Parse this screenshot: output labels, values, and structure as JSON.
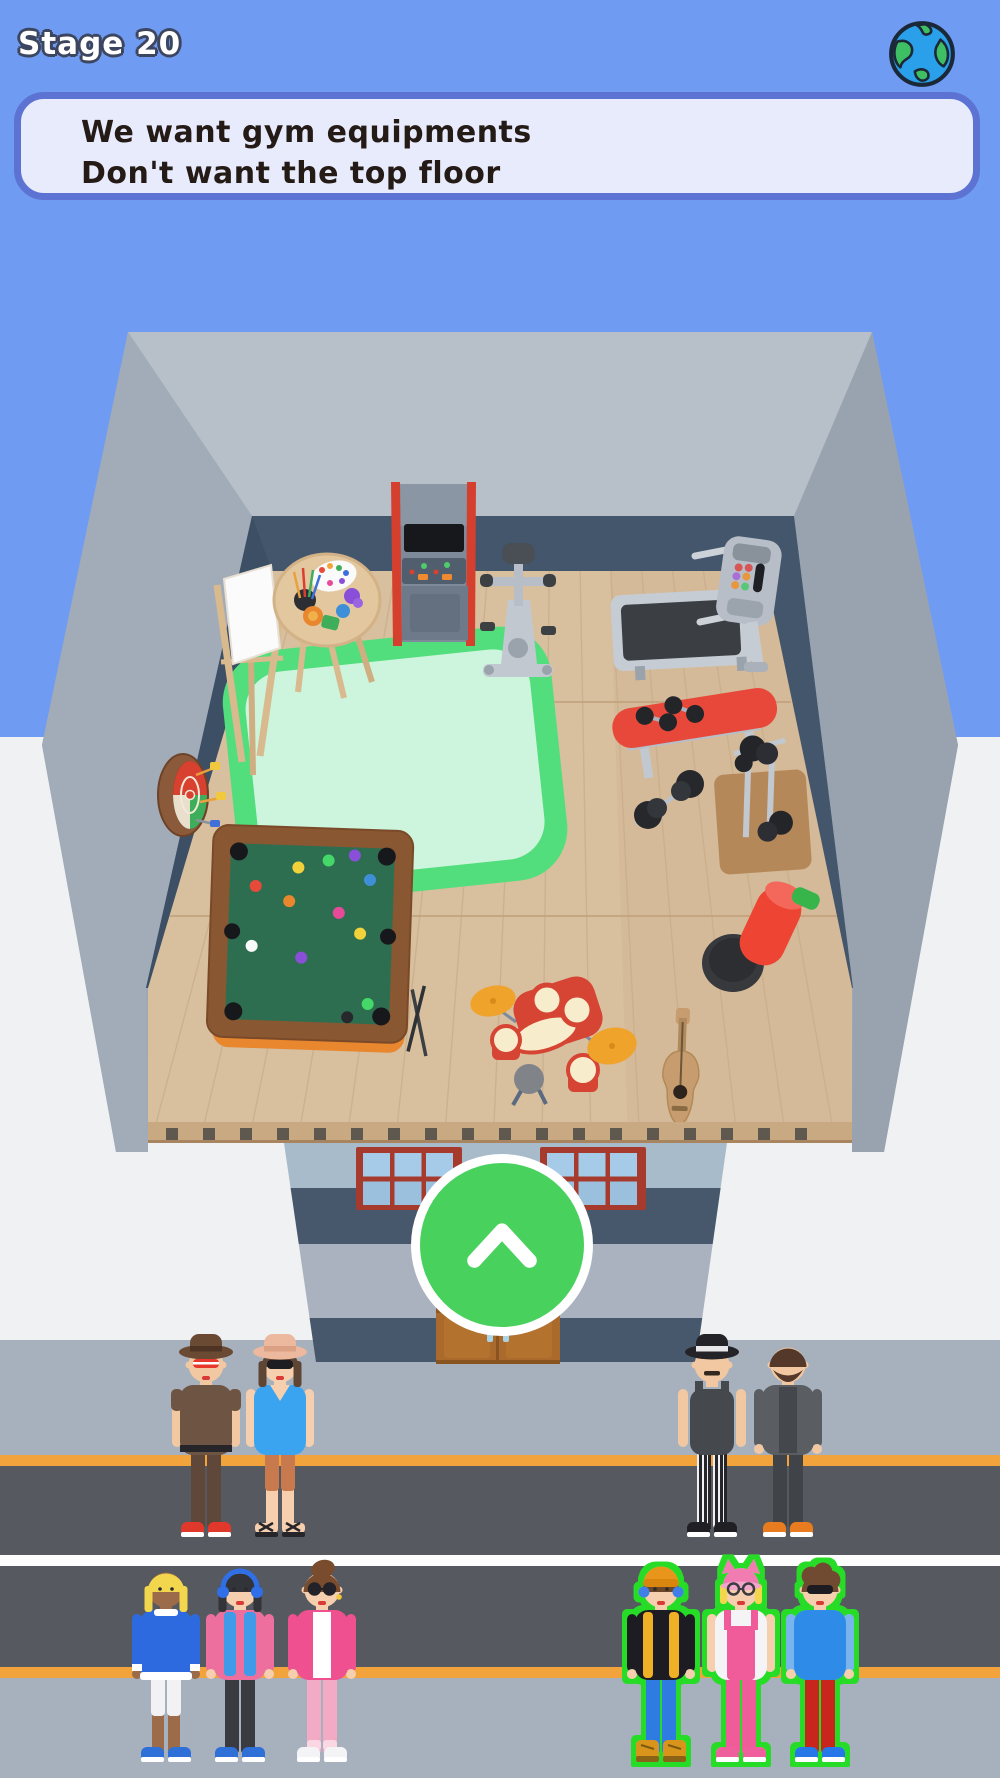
{
  "hud": {
    "stage_label": "Stage 20",
    "request_panel": {
      "lines": [
        "We want gym equipments",
        "Don't want the top floor"
      ]
    },
    "globe_icon": "earth-globe",
    "up_button_icon": "chevron-up"
  },
  "palette": {
    "sky": "#6f9cf2",
    "backdrop": "#eff1f2",
    "sidewalk": "#a7b1bd",
    "road": "#56595f",
    "lane_orange": "#f2a33c",
    "lane_white": "#fdfdfe",
    "wall_outer": "#9fa9b5",
    "wall_top": "#b7bfc9",
    "wall_left": "#a2acb8",
    "wall_right": "#99a3b0",
    "wall_inner": "#44566c",
    "floor_wood": "#d8bf9e",
    "slab_band": "#c8a981",
    "facade_light": "#a8bbcb",
    "facade_dark": "#47586c",
    "facade_mid": "#a9b2be",
    "window_frame": "#a63a2c",
    "window_pane": "#a6cbe8",
    "window_pane2": "#9bc0de",
    "door": "#a96a2c",
    "panel_bg": "#e7ebfb",
    "panel_border": "#5d73d4",
    "panel_text": "#241a16",
    "stage_text": "#ffffff",
    "stage_outline": "#3d4660",
    "button_green": "#49d15e",
    "button_border": "#ffffff",
    "highlight_green": "#26dc25"
  },
  "scene": {
    "room_items": [
      "easel",
      "art-table",
      "arcade-machine",
      "exercise-bike",
      "treadmill",
      "weight-bench",
      "barbell",
      "dumbbell-rack",
      "punching-bag",
      "green-rug",
      "dartboard",
      "pool-table",
      "drum-kit",
      "guitar"
    ]
  },
  "characters": [
    {
      "id": "cowboy-man",
      "group": "door-left",
      "cx": 206,
      "base": 1537,
      "skin": "#f2c8a2",
      "hat": {
        "type": "brim",
        "color": "#6b4a33",
        "band": "#4e3424"
      },
      "hair": null,
      "glasses": {
        "style": "stripe",
        "color": "#e8382c"
      },
      "top": {
        "style": "tee",
        "color": "#6d5443"
      },
      "arms": {
        "color": "skin",
        "sleeve": true
      },
      "bottom": {
        "style": "full",
        "color": "#5f483a"
      },
      "shoes": {
        "style": "sneaker",
        "color": "#e0392b"
      },
      "extras": [
        "belt",
        "lips"
      ],
      "highlighted": false
    },
    {
      "id": "sunhat-woman",
      "group": "door-left",
      "cx": 280,
      "base": 1537,
      "skin": "#f6cfae",
      "hat": {
        "type": "brim",
        "color": "#ecb89e",
        "band": "#dca084"
      },
      "hair": {
        "style": "bob",
        "color": "#5f4534"
      },
      "glasses": {
        "style": "shades",
        "color": "#1d1d22"
      },
      "top": {
        "style": "vneck",
        "color": "#3ba4f0"
      },
      "arms": {
        "color": "skin"
      },
      "bottom": {
        "style": "shorts",
        "color": "#c87a4e"
      },
      "shoes": {
        "style": "sandals",
        "color": "#26262a"
      },
      "extras": [
        "lips"
      ],
      "highlighted": false
    },
    {
      "id": "fedora-man",
      "group": "door-right",
      "cx": 712,
      "base": 1537,
      "skin": "#f2c8a2",
      "hat": {
        "type": "brim",
        "color": "#232328",
        "band": "#e8e8ea"
      },
      "hair": null,
      "glasses": null,
      "top": {
        "style": "tank",
        "color": "#45494e"
      },
      "arms": {
        "color": "skin"
      },
      "bottom": {
        "style": "striped",
        "color": "#f0f0f2",
        "color2": "#26262a"
      },
      "shoes": {
        "style": "sneaker",
        "color": "#1f1f24"
      },
      "extras": [
        "mustache"
      ],
      "highlighted": false
    },
    {
      "id": "bearded-man",
      "group": "door-right",
      "cx": 788,
      "base": 1537,
      "skin": "#f2c8a2",
      "hat": null,
      "hair": {
        "style": "short",
        "color": "#54392a"
      },
      "glasses": null,
      "top": {
        "style": "cardigan",
        "color": "#5a5e63",
        "color2": "#44484d"
      },
      "arms": {
        "color": "#5a5e63"
      },
      "bottom": {
        "style": "full",
        "color": "#404348"
      },
      "shoes": {
        "style": "sneaker",
        "color": "#e87c1e"
      },
      "extras": [
        "beard"
      ],
      "highlighted": false
    },
    {
      "id": "blonde-kid",
      "group": "street-left",
      "cx": 166,
      "base": 1762,
      "skin": "#9c6b4a",
      "hat": null,
      "hair": {
        "style": "bob",
        "color": "#f2d74e"
      },
      "glasses": null,
      "top": {
        "style": "sweater",
        "color": "#2d6adf"
      },
      "arms": {
        "color": "#2d6adf"
      },
      "bottom": {
        "style": "shorts",
        "color": "#f2f2f4"
      },
      "shoes": {
        "style": "sneaker",
        "color": "#2f6fd8"
      },
      "extras": [
        "eyes"
      ],
      "highlighted": false
    },
    {
      "id": "headphones-girl",
      "group": "street-left",
      "cx": 240,
      "base": 1762,
      "skin": "#f6cfae",
      "hat": null,
      "hair": {
        "style": "bob",
        "color": "#33343a"
      },
      "glasses": null,
      "top": {
        "style": "jacket",
        "color": "#ec6f9e",
        "color2": "#3f9ae8"
      },
      "arms": {
        "color": "#ec6f9e"
      },
      "bottom": {
        "style": "full",
        "color": "#3a3b40"
      },
      "shoes": {
        "style": "sneaker",
        "color": "#2f6fd8"
      },
      "extras": [
        "headphones",
        "eyes",
        "lips"
      ],
      "highlighted": false
    },
    {
      "id": "pink-cardigan",
      "group": "street-left",
      "cx": 322,
      "base": 1762,
      "skin": "#f6cfae",
      "hat": null,
      "hair": {
        "style": "pomp",
        "color": "#7a4c2e"
      },
      "glasses": {
        "style": "round",
        "color": "#222228",
        "fill": true
      },
      "top": {
        "style": "cardigan",
        "color": "#ef5090",
        "color2": "#ffffff"
      },
      "arms": {
        "color": "#ef5090"
      },
      "bottom": {
        "style": "full",
        "color": "#f3aac4",
        "color2": "#fbd7e4"
      },
      "shoes": {
        "style": "sneaker",
        "color": "#f4f4f6"
      },
      "extras": [
        "earring",
        "lips"
      ],
      "highlighted": false
    },
    {
      "id": "vest-boy",
      "group": "street-right",
      "cx": 661,
      "base": 1762,
      "skin": "#f6cfae",
      "hat": {
        "type": "beanie",
        "color": "#e8951f",
        "band": "#d8860f"
      },
      "hair": {
        "style": "fringe",
        "color": "#6b4426"
      },
      "glasses": null,
      "top": {
        "style": "vest",
        "color": "#1f1f23",
        "color2": "#f0b028"
      },
      "arms": {
        "color": "#1f1f23"
      },
      "bottom": {
        "style": "full",
        "color": "#2e7ce2"
      },
      "shoes": {
        "style": "boots",
        "color": "#d9941f"
      },
      "extras": [
        "earpads",
        "eyes",
        "lips"
      ],
      "highlighted": true
    },
    {
      "id": "catear-girl",
      "group": "street-right",
      "cx": 741,
      "base": 1762,
      "skin": "#f6cfae",
      "hat": {
        "type": "catear",
        "color": "#f07cb2",
        "band": "#f3a6cb"
      },
      "hair": {
        "style": "sides",
        "color": "#f2d74e"
      },
      "glasses": {
        "style": "round",
        "color": "#3a3a40",
        "fill": false
      },
      "top": {
        "style": "overalls",
        "color": "#f4f4f6",
        "color2": "#f05c9a"
      },
      "arms": {
        "color": "skin"
      },
      "bottom": {
        "style": "full",
        "color": "#f05c9a"
      },
      "shoes": {
        "style": "sneaker",
        "color": "#ef5f9d"
      },
      "extras": [
        "lips"
      ],
      "highlighted": true
    },
    {
      "id": "curly-boy",
      "group": "street-right",
      "cx": 820,
      "base": 1762,
      "skin": "#f6cfae",
      "hat": null,
      "hair": {
        "style": "curly",
        "color": "#6f4c31"
      },
      "glasses": {
        "style": "shades",
        "color": "#1d1d22"
      },
      "top": {
        "style": "tee",
        "color": "#2f8ce8"
      },
      "arms": {
        "color": "#7ab4ec"
      },
      "bottom": {
        "style": "full",
        "color": "#c8251a"
      },
      "shoes": {
        "style": "sneaker",
        "color": "#2778e8"
      },
      "extras": [
        "lips"
      ],
      "highlighted": true
    }
  ]
}
